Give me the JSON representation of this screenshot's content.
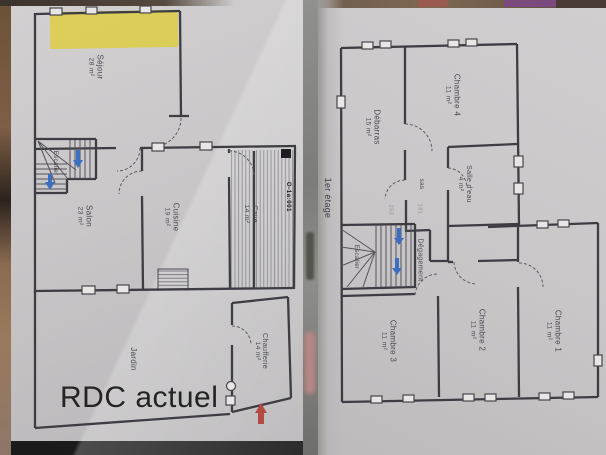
{
  "rdc": {
    "title": "RDC actuel",
    "stamp": "O-1a:001",
    "rooms": {
      "sejour": {
        "name": "Séjour",
        "area": "28 m²"
      },
      "salon": {
        "name": "Salon",
        "area": "23 m²"
      },
      "cuisine": {
        "name": "Cuisine",
        "area": "19 m²"
      },
      "cave": {
        "name": "Cave",
        "area": "14 m²"
      },
      "chaufferie": {
        "name": "Chaufferie",
        "area": "14 m²"
      },
      "jardin": {
        "name": "Jardin"
      },
      "escalier": {
        "name": "Escalier"
      }
    }
  },
  "etage": {
    "title": "Etage actuel",
    "floor_note": "1er étage",
    "pencil_notes": {
      "left": "253",
      "right": "181"
    },
    "rooms": {
      "debarras": {
        "name": "Débarras",
        "area": "15 m²"
      },
      "chambre4": {
        "name": "Chambre 4",
        "area": "11 m²"
      },
      "salle_deau": {
        "name": "Salle d'eau",
        "area": "4 m²"
      },
      "sas": {
        "name": "sas"
      },
      "degagement": {
        "name": "Dégagement"
      },
      "escalier": {
        "name": "Escalier"
      },
      "chambre3": {
        "name": "Chambre 3",
        "area": "11 m²"
      },
      "chambre2": {
        "name": "Chambre 2",
        "area": "11 m²"
      },
      "chambre1": {
        "name": "Chambre 1",
        "area": "11 m²"
      }
    }
  },
  "colors": {
    "highlight": "#ddce48",
    "wall_line": "#3e3d43",
    "stair_arrow_blue": "#3c6fc0",
    "entry_arrow_red": "#b34a44"
  }
}
